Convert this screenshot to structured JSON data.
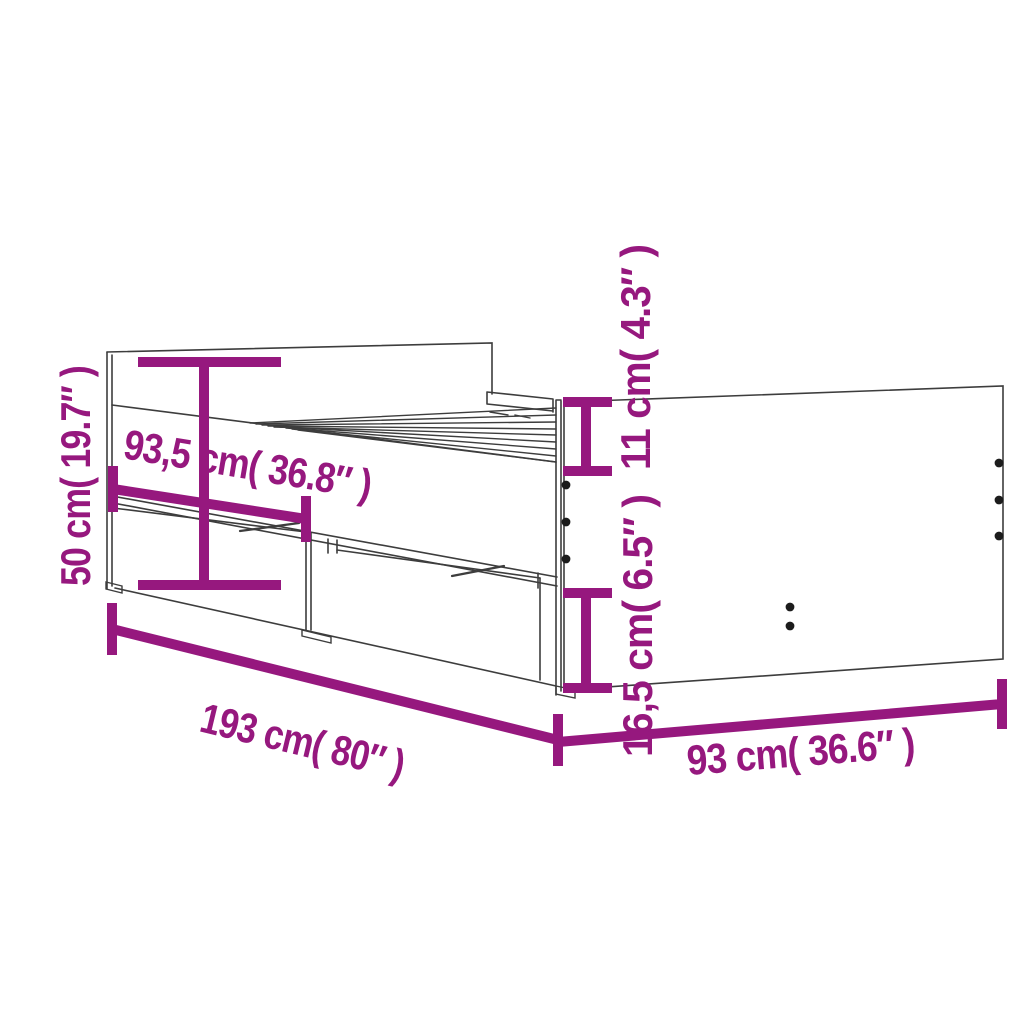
{
  "figure": {
    "title": "bed-frame-with-drawers-dimension-diagram",
    "background_color": "#ffffff",
    "line_color": "#3d3d3d",
    "accent_color": "#96187E",
    "dot_color": "#1c1c1c",
    "dimensions": {
      "total_height": {
        "label": "50 cm( 19.7″ )",
        "cm": "50",
        "inches": "19.7"
      },
      "drawer_module_length": {
        "label": "93,5 cm( 36.8″ )",
        "cm": "93,5",
        "inches": "36.8"
      },
      "top_rail_height": {
        "label": "11 cm( 4.3″ )",
        "cm": "11",
        "inches": "4.3"
      },
      "drawer_height": {
        "label": "16,5 cm( 6.5″ )",
        "cm": "16,5",
        "inches": "6.5"
      },
      "total_length": {
        "label": "193 cm( 80″ )",
        "cm": "193",
        "inches": "80"
      },
      "total_width": {
        "label": "93 cm( 36.6″ )",
        "cm": "93",
        "inches": "36.6"
      }
    }
  }
}
